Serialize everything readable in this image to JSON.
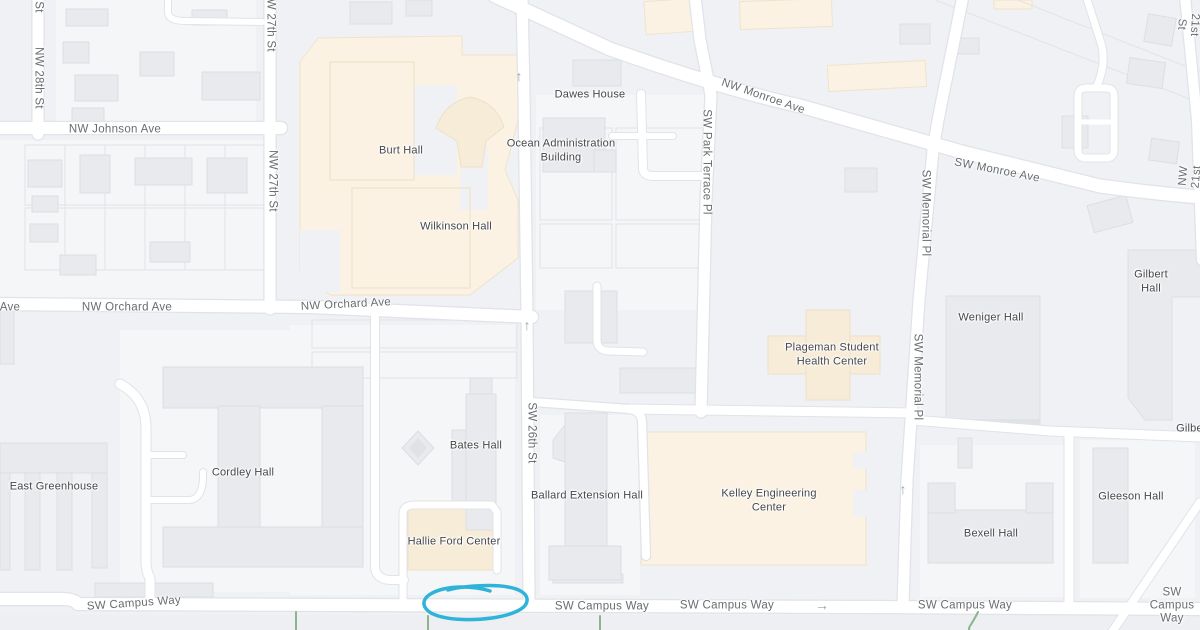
{
  "colors": {
    "background": "#eff1f4",
    "road": "#ffffff",
    "road_casing": "#e0e3e7",
    "building": "#e9eaed",
    "building_border": "#dcdee2",
    "campus": "#fbf2e3",
    "campus_border": "#efe3cd",
    "green_path": "#8cb48e",
    "street_label": "#696c70",
    "poi_label": "#47474b",
    "highlight": "#2fb3d9",
    "arrow": "#9aa0a6"
  },
  "streets": [
    {
      "text": "St"
    },
    {
      "text": "NW 28th St"
    },
    {
      "text": "NW Johnson Ave"
    },
    {
      "text": "NW 27th St"
    },
    {
      "text": "NW 27th St"
    },
    {
      "text": "NW Monroe Ave"
    },
    {
      "text": "SW Park Terrace Pl"
    },
    {
      "text": "SW Monroe Ave"
    },
    {
      "text": "SW Memorial Pl"
    },
    {
      "text": "NW 21st St"
    },
    {
      "text": "NW 21st St"
    },
    {
      "text": "Ave"
    },
    {
      "text": "NW Orchard Ave"
    },
    {
      "text": "NW Orchard Ave"
    },
    {
      "text": "SW 26th St"
    },
    {
      "text": "SW Memorial Pl"
    },
    {
      "text": "SW Campus Way"
    },
    {
      "text": "SW Campus Way"
    },
    {
      "text": "SW Campus Way"
    },
    {
      "text": "SW Campus Way"
    },
    {
      "text": "SW Campus Way"
    }
  ],
  "places": [
    {
      "text": "Dawes House"
    },
    {
      "text": "Ocean Administration\nBuilding"
    },
    {
      "text": "Burt Hall"
    },
    {
      "text": "Wilkinson Hall"
    },
    {
      "text": "Plageman Student\nHealth Center"
    },
    {
      "text": "Weniger Hall"
    },
    {
      "text": "Gilbert Hall"
    },
    {
      "text": "Gilbert"
    },
    {
      "text": "East Greenhouse"
    },
    {
      "text": "Cordley Hall"
    },
    {
      "text": "Bates Hall"
    },
    {
      "text": "Ballard Extension Hall"
    },
    {
      "text": "Hallie Ford Center"
    },
    {
      "text": "Kelley Engineering\nCenter"
    },
    {
      "text": "Bexell Hall"
    },
    {
      "text": "Gleeson Hall"
    }
  ],
  "icons": [
    {
      "name": "one-way-up-arrow",
      "glyph": "↑"
    },
    {
      "name": "one-way-up-arrow",
      "glyph": "↑"
    },
    {
      "name": "one-way-up-arrow",
      "glyph": "↑"
    },
    {
      "name": "one-way-right-arrow",
      "glyph": "→"
    }
  ],
  "annotation": {
    "shape": "hand-drawn-ellipse",
    "color": "#2fb3d9",
    "location": "parking area west of SW 26th St on SW Campus Way"
  }
}
